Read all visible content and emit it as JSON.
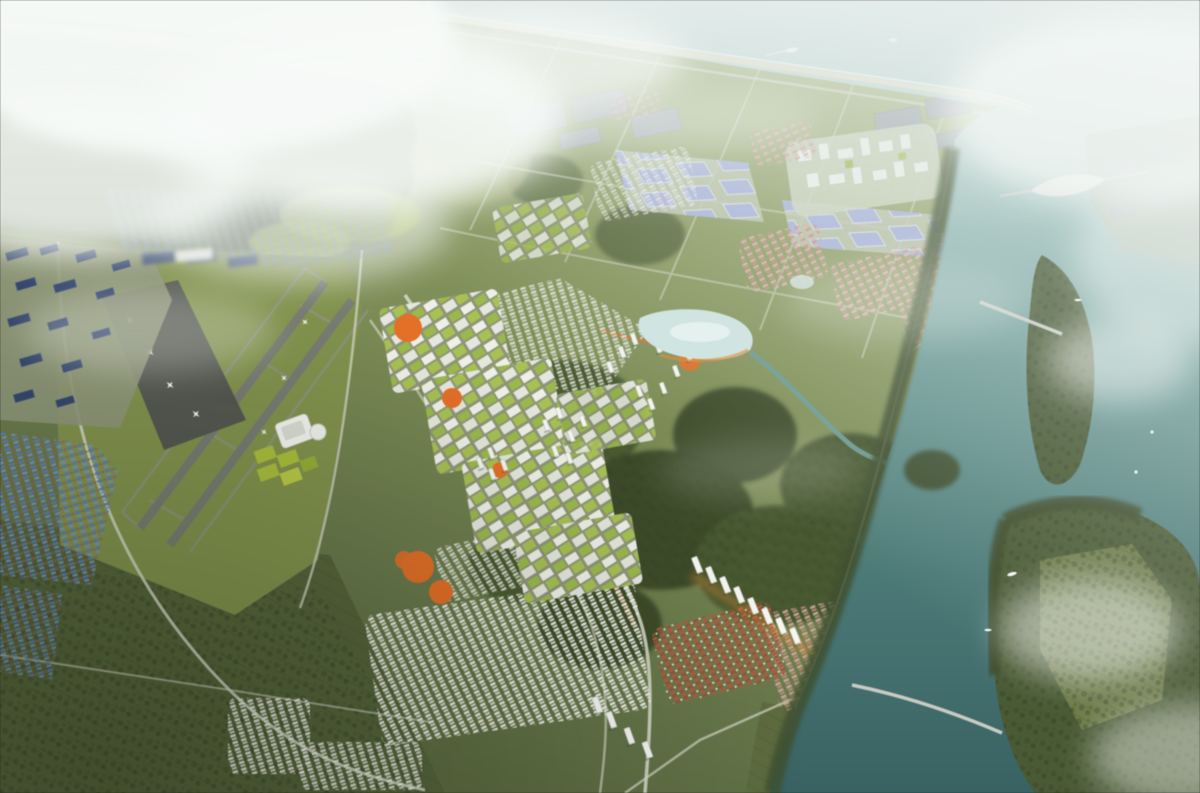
{
  "meta": {
    "type": "aerial-masterplan-rendering",
    "view": "high-altitude oblique aerial visualization, no text or UI overlays",
    "width": 1200,
    "height": 793
  },
  "palette": {
    "land_base": "#66754a",
    "land_dark": "#4f5d38",
    "land_light": "#93a26c",
    "forest": "#4a5a33",
    "forest_dark": "#3c4c2b",
    "grass_airport": "#81914f",
    "runway_grey": "#777b72",
    "taxiway_grey": "#8e927f",
    "apron_dark": "#54574f",
    "road_light": "#d4d6c8",
    "sea_pale": "#cfdedd",
    "river_teal": "#4d7a77",
    "river_deep": "#3a6263",
    "beach_sand": "#e8dfc2",
    "cloud_white": "#f7faf8",
    "solar_panel": "#a9b2d6",
    "solar_roof_dark": "#36466a",
    "warehouse_grey": "#9da3a6",
    "building_white": "#eceee8",
    "roof_green": "#9cb84f",
    "accent_orange": "#e0702b",
    "roof_red": "#b05c45",
    "roof_pink": "#cfaea6",
    "roof_blue": "#5d7fab",
    "bridge_grey": "#c9cbc4",
    "field_olive": "#5c6a3f"
  },
  "scene": {
    "regions": [
      {
        "name": "sea",
        "note": "pale hazy sea along top edge"
      },
      {
        "name": "beach-coastline",
        "note": "sand barrier beach running diagonally"
      },
      {
        "name": "river-estuary",
        "note": "teal river widening toward bottom right"
      },
      {
        "name": "islands",
        "note": "tree-covered islands with interior fields and mist"
      },
      {
        "name": "airport",
        "note": "twin diagonal runways, dark apron with parked aircraft, white terminal, bright green plots"
      },
      {
        "name": "central-urban-spine",
        "note": "diagonal grid of green-roofed blocks, white towers, orange plazas"
      },
      {
        "name": "lake",
        "note": "small reflective lake beside tower cluster"
      },
      {
        "name": "solar-farms",
        "note": "two lavender photovoltaic panel arrays"
      },
      {
        "name": "warehouse-district",
        "note": "grey industrial boxes near the coast"
      },
      {
        "name": "innovation-campus",
        "note": "white mid-rise cluster upper right"
      },
      {
        "name": "residential-districts",
        "note": "white, pink, red and blue-roof housing clusters"
      },
      {
        "name": "farmland-orchards",
        "note": "dark olive fields and orchard rows bottom left"
      },
      {
        "name": "forest",
        "note": "dense dark-green woodland through the center"
      },
      {
        "name": "clouds-haze",
        "note": "large cloud mass top-left, coastal haze, mist over islands"
      }
    ],
    "landmarks": [
      "lens-shaped-bridge",
      "straight-road-bridge",
      "south-river-bridge",
      "airport-terminal",
      "tower-row",
      "orange-civic-plazas"
    ],
    "counts": {
      "runways": 2,
      "bridges": 3,
      "boats": 7,
      "aircraft": 7,
      "solar_fields": 2
    }
  }
}
